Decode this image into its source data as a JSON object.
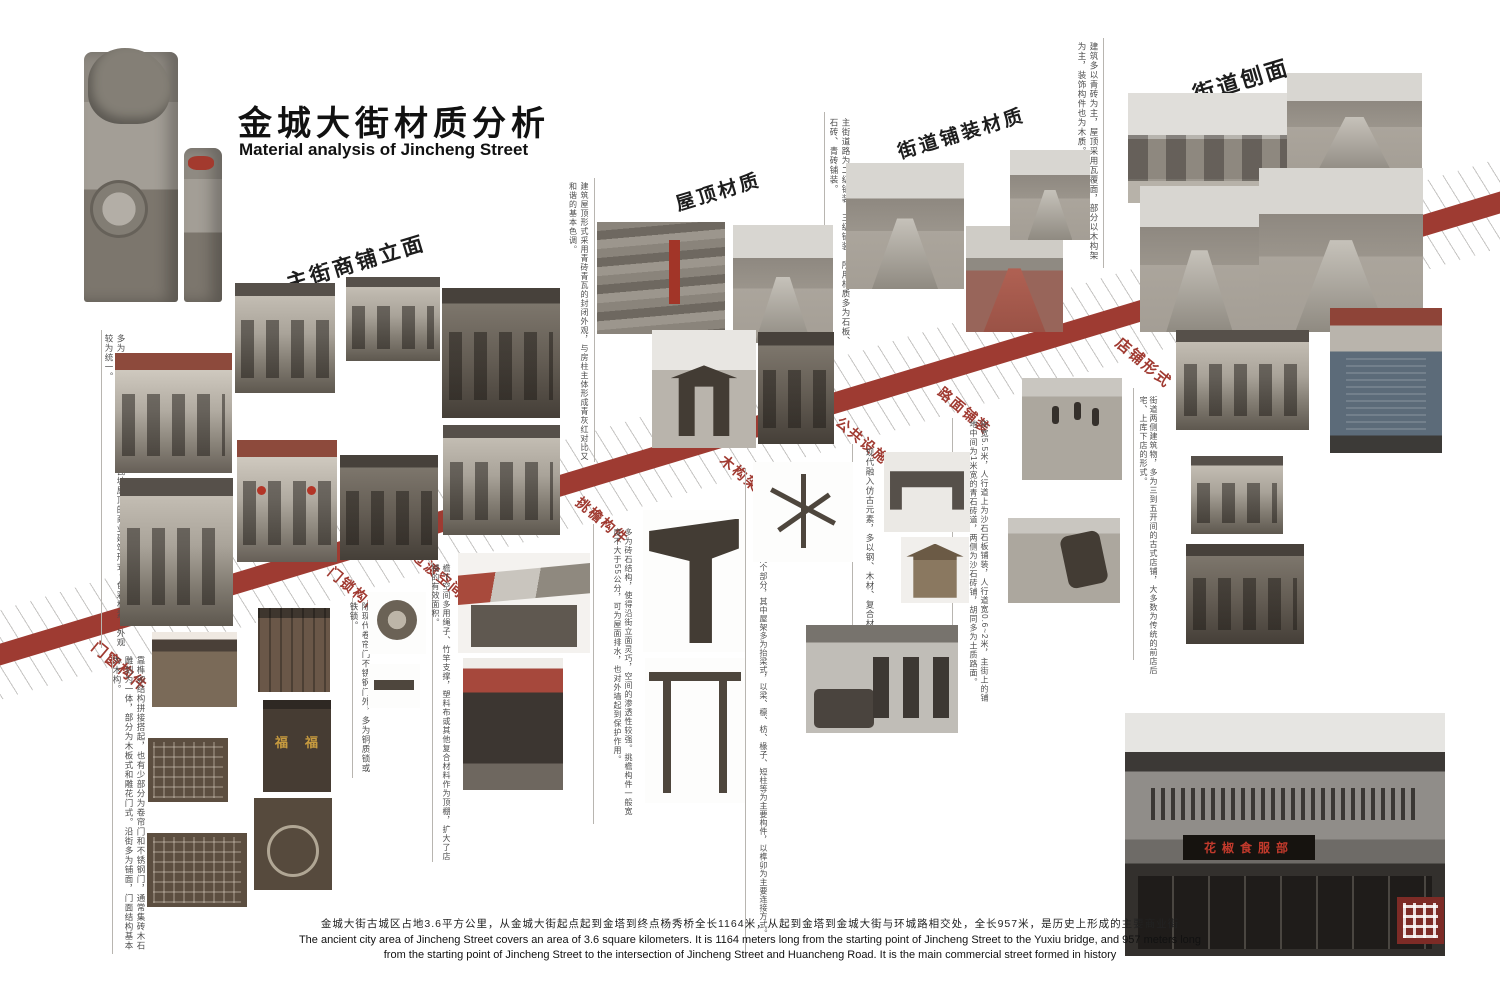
{
  "title": {
    "zh": "金城大街材质分析",
    "en": "Material analysis of Jincheng Street"
  },
  "sections_top": [
    {
      "id": "main-street-facade",
      "label": "主街商铺立面",
      "note": "多为两层砖木结构楼房，青砖灰瓦坡屋顶的商业建筑形式，色彩朴素，外观较为统一。"
    },
    {
      "id": "roof-material",
      "label": "屋顶材质",
      "note": "建筑屋顶形式采用青砖青瓦的封闭外观，与房柱主体形成青灰红对比又和谐的基本色调。"
    },
    {
      "id": "street-paving-material",
      "label": "街道铺装材质",
      "note": "主街道路为二级铺装、三级铺装，所用材质多为石板、石砖、青砖铺装。"
    },
    {
      "id": "street-section",
      "label": "街道刨面",
      "note": "建筑多以青砖为主，屋顶采用瓦覆面，部分以木构架为主，装饰构件也为木质。"
    }
  ],
  "sections_bottom": [
    {
      "id": "door-window-components",
      "label": "门窗构件",
      "note": "靠榫卯结构拼接搭起，也有少部分为卷帘门和不锈钢门，通常集砖木石雕刻为一体，部分为木板式和雕花门式。沿街多为铺面，门面结构基本为木构。"
    },
    {
      "id": "door-lock-components",
      "label": "门锁构件",
      "note": "除现代卷帘门不锈钢门外，多为铜质锁或铁锁。"
    },
    {
      "id": "transition-space",
      "label": "过渡空间",
      "note": "檐下空间多用绳子、竹竿支撑，塑料布或其他复合材料作为顶棚，扩大了店铺的有效面积。"
    },
    {
      "id": "eave-components",
      "label": "挑檐构件",
      "note": "多为砖石结构，使得沿街立面灵巧，空间的渗透性较强。挑檐构件一般宽度不大于55公分，可为屋面排水，也对外墙起到保护作用。"
    },
    {
      "id": "timber-frame",
      "label": "木构架",
      "note": "木构架可分为屋架和柱两个部分，其中屋架多为抬梁式，以梁、檩、枋、椽子、短柱等为主要构件，以榫卯为主要连接方式。"
    },
    {
      "id": "public-facilities",
      "label": "公共设施",
      "note": "现代融入仿古元素，多以钢、木材、复合材料为主。"
    },
    {
      "id": "road-pavement",
      "label": "路面铺装",
      "note": "街宽5.5米，人行道上为沙石石板铺装，人行道宽0.6~2米，主街上的铺地中间为1米宽的青石砖道，两侧为沙石砖铺，胡同多为土质路面。"
    },
    {
      "id": "shop-form",
      "label": "店铺形式",
      "note": "街道两侧建筑物，多为三到五开间的古式店铺，大多数为传统的前店后宅、上库下店的形式。"
    }
  ],
  "footer": {
    "zh": "金城大街古城区占地3.6平方公里，从金城大街起点起到金塔到终点杨秀桥全长1164米，从起到金塔到金城大街与环城路相交处，全长957米，是历史上形成的主要商业街",
    "en_line1": "The ancient city area of Jincheng Street covers an area of 3.6 square kilometers. It is 1164 meters long from the starting point of Jincheng Street to the Yuxiu bridge, and 957 meters long",
    "en_line2": "from the starting point of Jincheng Street to the intersection of Jincheng Street and Huancheng Road. It is the main commercial street formed in history"
  },
  "shop_photo": {
    "sign": "花椒食服部"
  },
  "door_plaque": "福",
  "colors": {
    "band_red": "#9e3b32",
    "label_red": "#a03a31",
    "accent_red": "#a23528",
    "seal_red": "#7d2b26"
  }
}
